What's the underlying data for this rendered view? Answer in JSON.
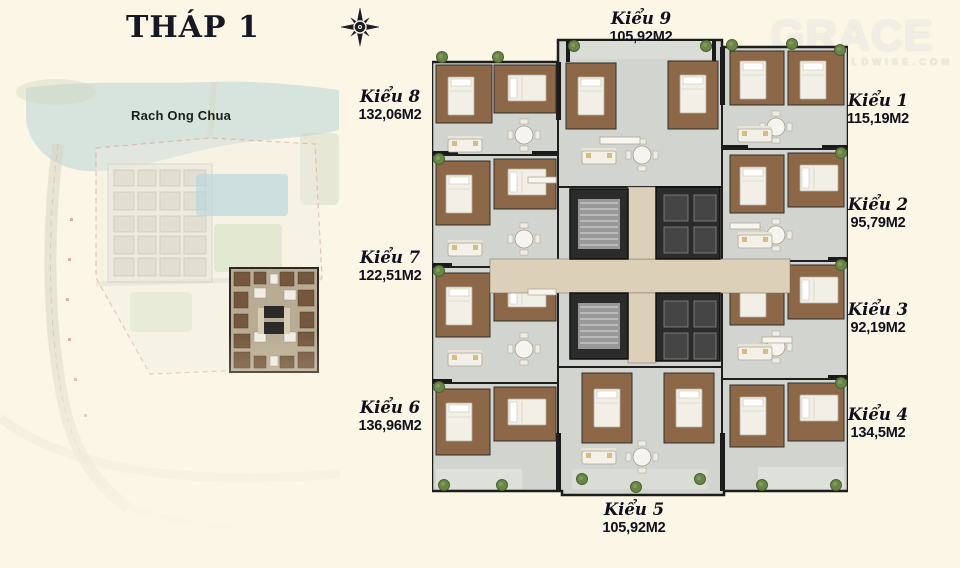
{
  "title": "THÁP 1",
  "watermark": {
    "brand": "GRACE",
    "domain": "GRACEWORLDWISE.COM"
  },
  "site_map": {
    "water_label": "Rach Ong Chua"
  },
  "icons": {
    "compass": "compass-rose-icon"
  },
  "units": [
    {
      "label": "Kiểu 1",
      "area": "115,19M2"
    },
    {
      "label": "Kiểu 2",
      "area": "95,79M2"
    },
    {
      "label": "Kiểu 3",
      "area": "92,19M2"
    },
    {
      "label": "Kiểu 4",
      "area": "134,5M2"
    },
    {
      "label": "Kiểu 5",
      "area": "105,92M2"
    },
    {
      "label": "Kiểu 6",
      "area": "136,96M2"
    },
    {
      "label": "Kiểu 7",
      "area": "122,51M2"
    },
    {
      "label": "Kiểu 8",
      "area": "132,06M2"
    },
    {
      "label": "Kiểu 9",
      "area": "105,92M2"
    }
  ],
  "colors": {
    "background": "#fbf6e5",
    "text": "#14141f",
    "plan_room_brown": "#8c6848",
    "plan_floor_gray": "#d2d4d0",
    "corridor_beige": "#dcd1b8",
    "core_dark": "#2b2b2b",
    "water_blue": "#b9d3d7",
    "plant_green": "#6a8647"
  }
}
